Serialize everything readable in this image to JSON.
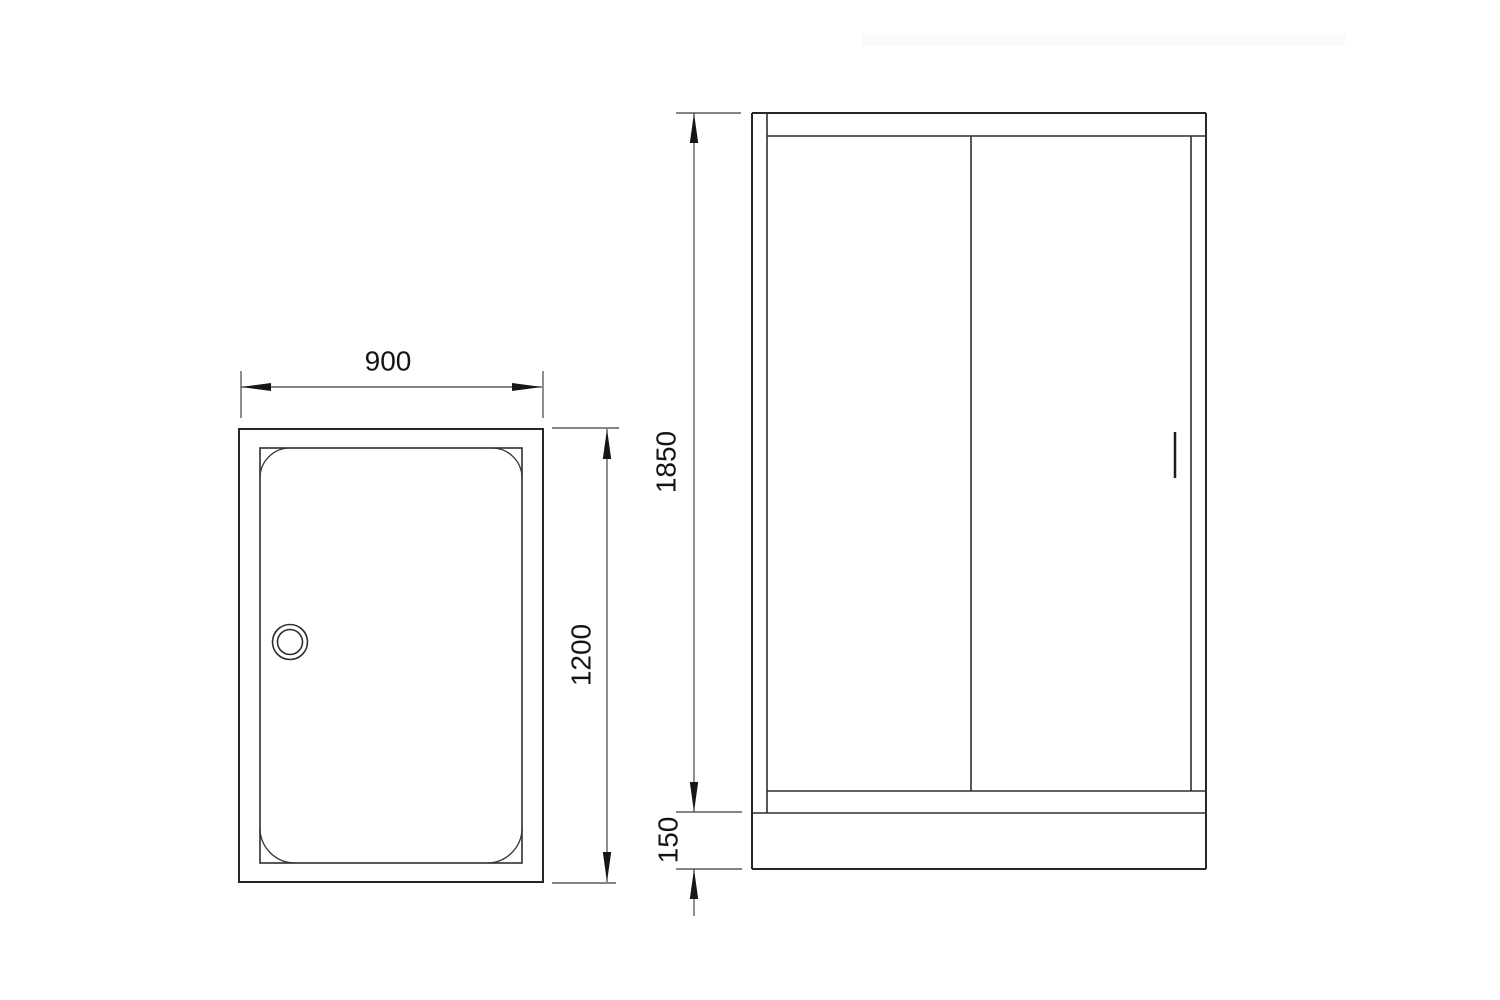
{
  "diagram": {
    "background_color": "#ffffff",
    "line_color": "#262626",
    "text_color": "#141414",
    "watermark_color": "#fafafa",
    "views": {
      "top_view": {
        "id": "shower-tray-top-view"
      },
      "front_view": {
        "id": "shower-enclosure-front-view"
      }
    },
    "dimensions": {
      "tray_width": {
        "label": "900"
      },
      "tray_depth": {
        "label": "1200"
      },
      "door_height": {
        "label": "1850"
      },
      "base_height": {
        "label": "150"
      }
    }
  }
}
